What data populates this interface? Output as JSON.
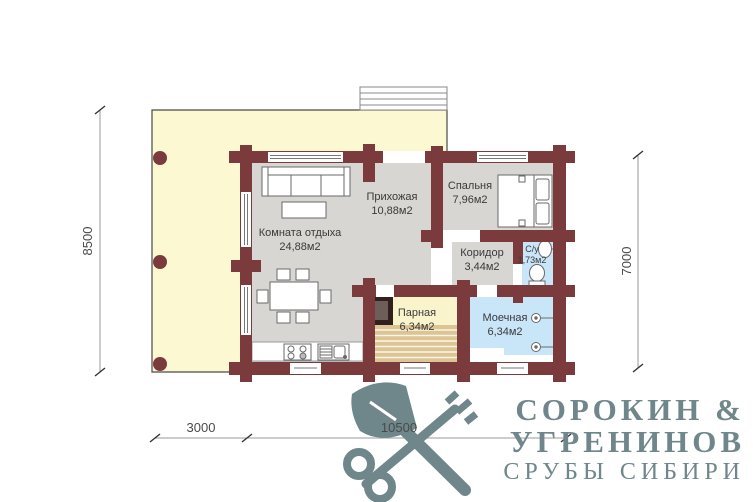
{
  "plan": {
    "rooms": [
      {
        "name": "Комната отдыха",
        "area": "24,88м2"
      },
      {
        "name": "Прихожая",
        "area": "10,88м2"
      },
      {
        "name": "Спальня",
        "area": "7,96м2"
      },
      {
        "name": "Коридор",
        "area": "3,44м2"
      },
      {
        "name": "С/у",
        "area": "1,73м2"
      },
      {
        "name": "Парная",
        "area": "6,34м2"
      },
      {
        "name": "Моечная",
        "area": "6,34м2"
      }
    ],
    "dimensions": {
      "height_total": "8500",
      "height_house": "7000",
      "width_terrace": "3000",
      "width_house": "10500"
    },
    "colors": {
      "walls": "#7B3A3B",
      "terrace": "#FBF8D2",
      "rooms_floor": "#D7D6D3",
      "wet_rooms": "#C9E5F8",
      "sauna_floor": "#FAF4CC",
      "logo": "#6F868A"
    }
  },
  "logo": {
    "line1": "СОРОКИН &",
    "line2": "УГРЕНИНОВ",
    "line3": "СРУБЫ СИБИРИ"
  }
}
